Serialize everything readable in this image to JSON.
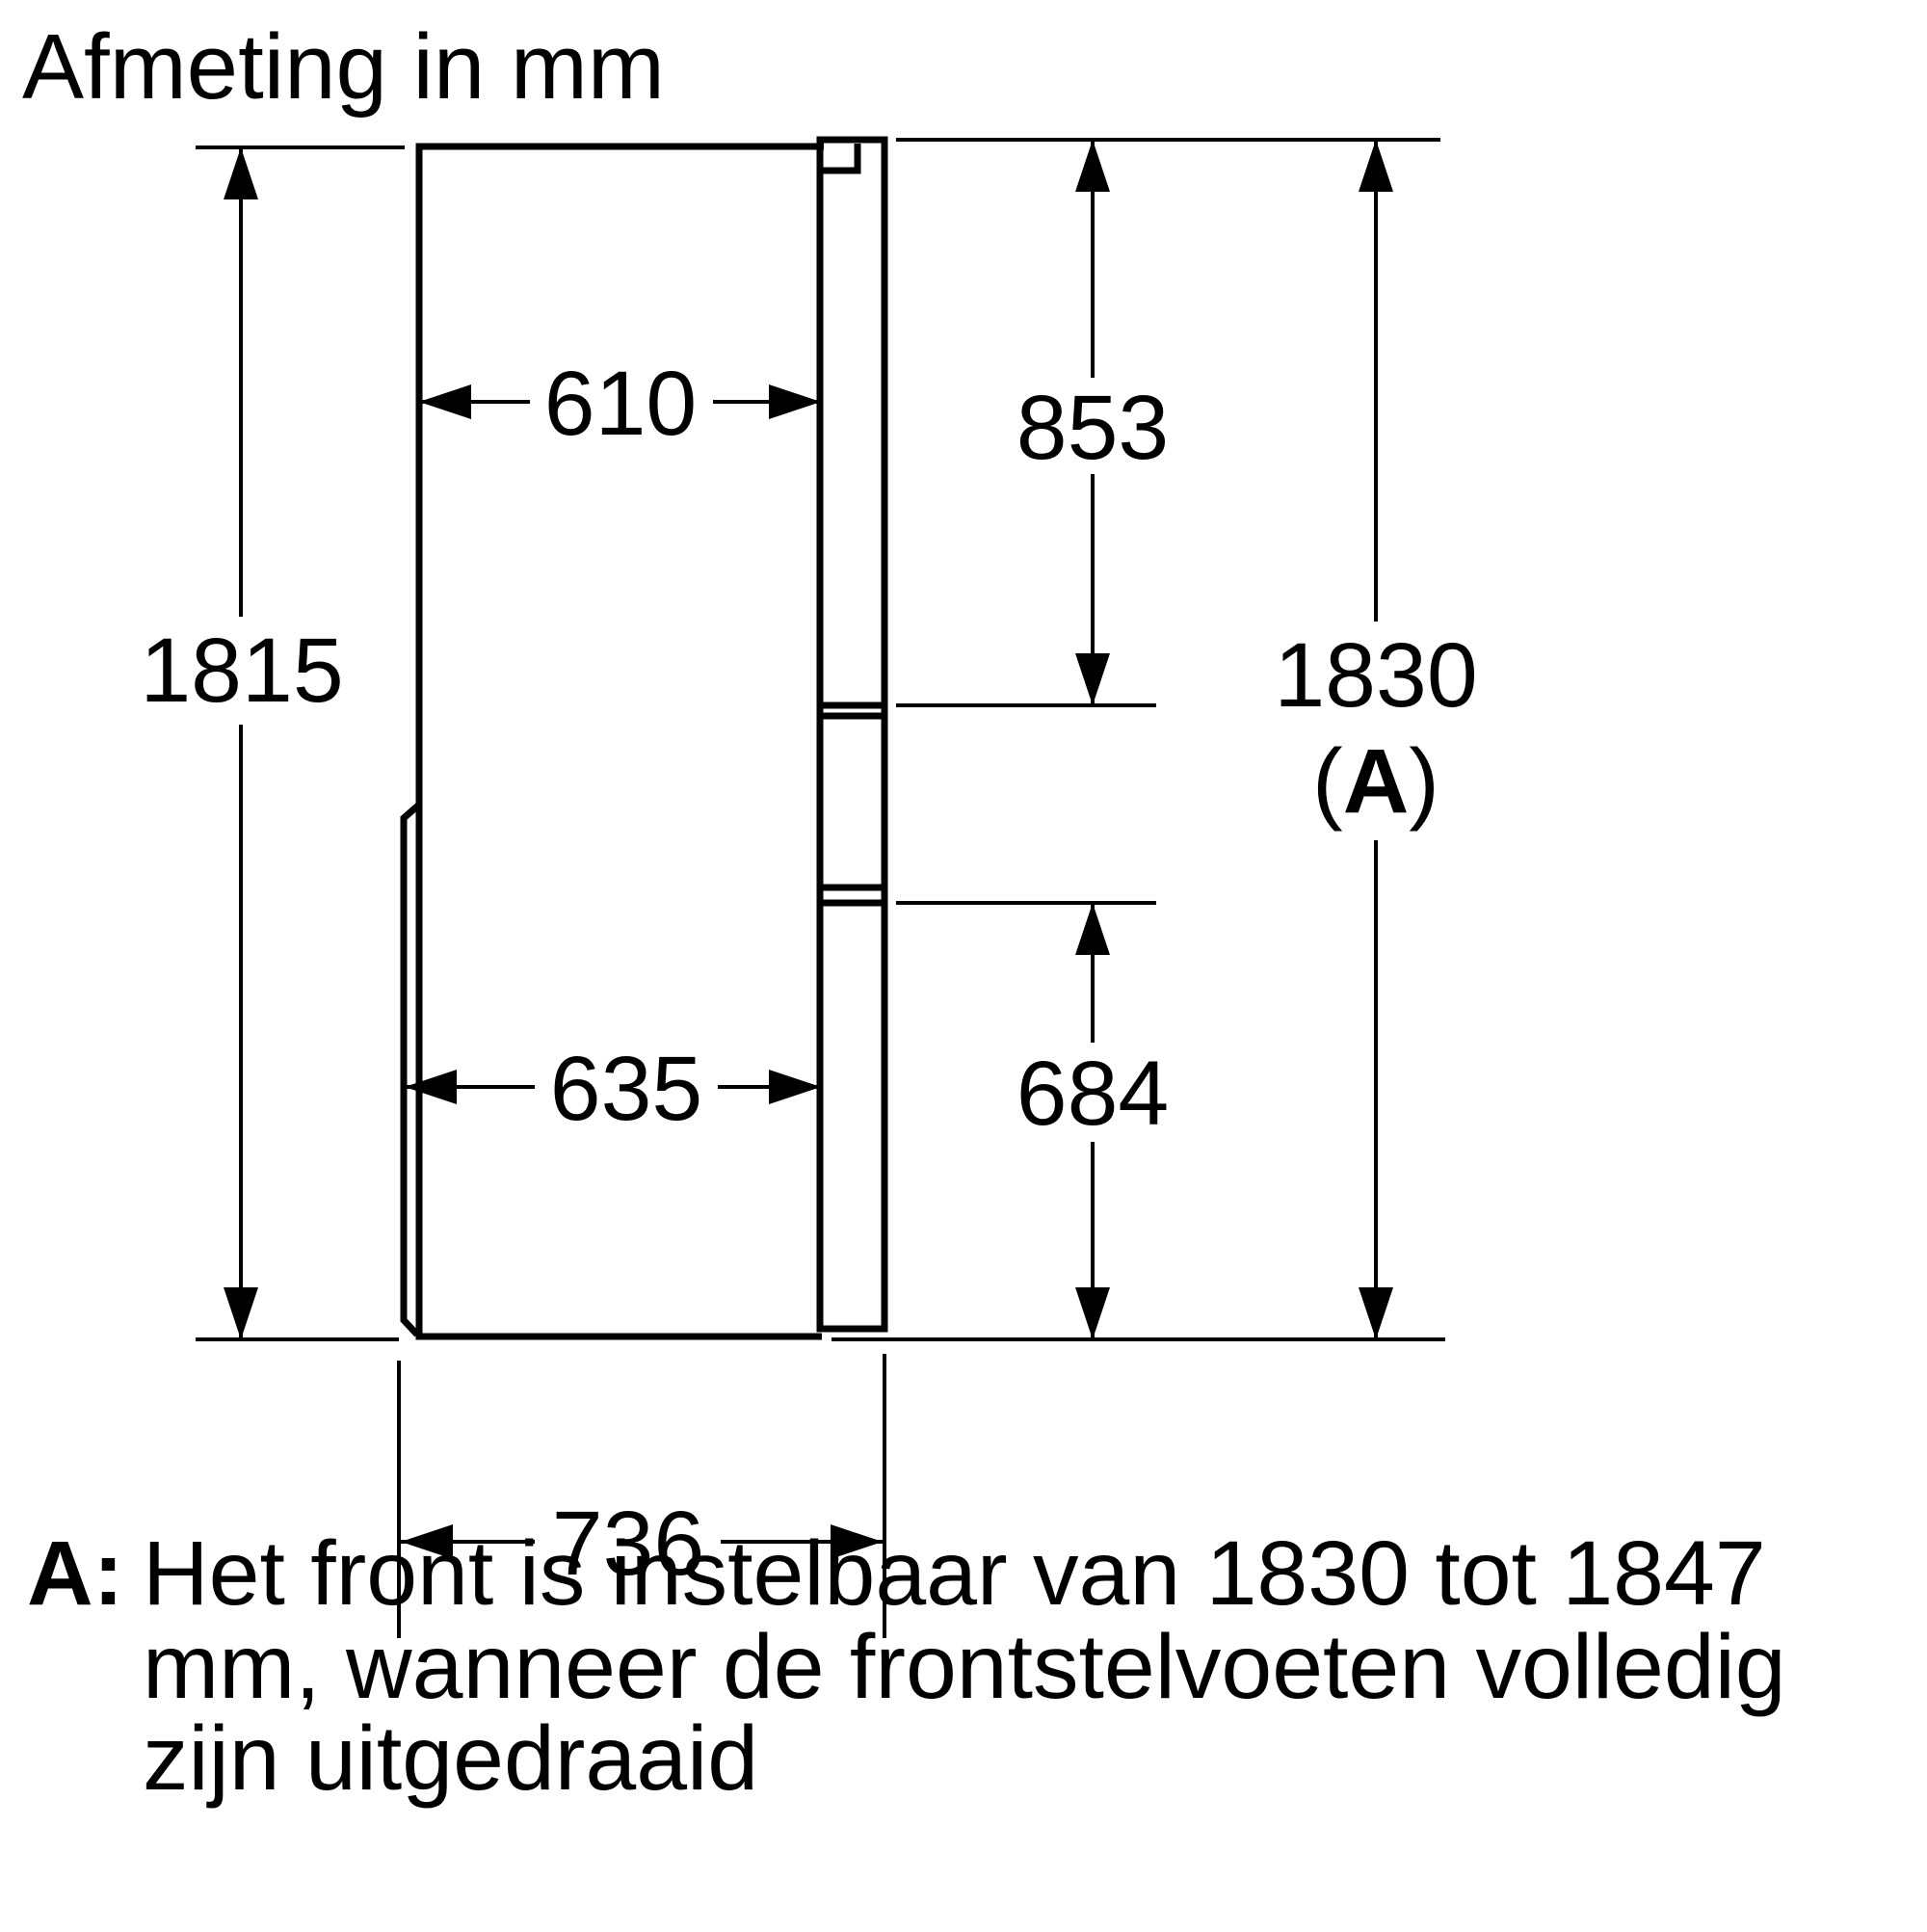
{
  "title": "Afmeting in mm",
  "diagram": {
    "dims": {
      "body_height": "1815",
      "body_depth_top": "610",
      "upper_door_height": "853",
      "overall_height": "1830",
      "paren_open": "(",
      "key_letter": "A",
      "paren_close": ")",
      "body_depth_bottom": "635",
      "lower_section_height": "684",
      "overall_depth": "736"
    }
  },
  "footnote": {
    "key": "A:",
    "lines": [
      "Het front is instelbaar van 1830 tot 1847",
      "mm, wanneer de frontstelvoeten volledig",
      "zijn uitgedraaid"
    ]
  }
}
